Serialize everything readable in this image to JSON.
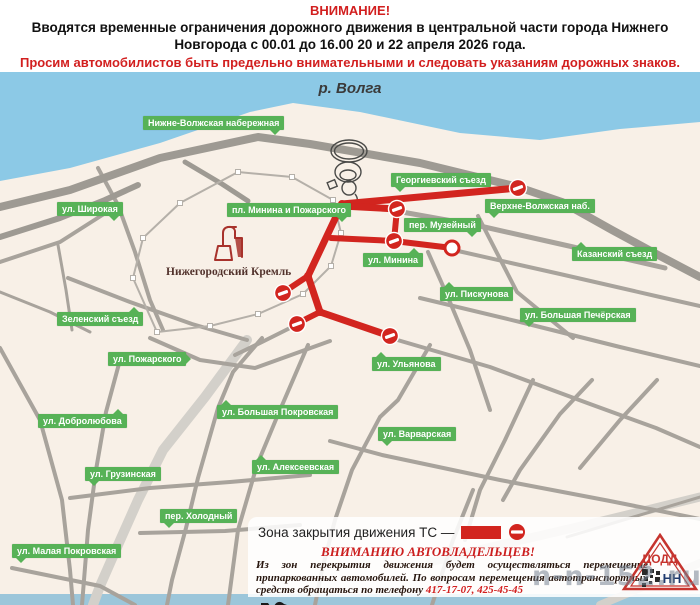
{
  "header": {
    "title": "ВНИМАНИЕ!",
    "body": "Вводятся временные ограничения дорожного движения в центральной части города Нижнего Новгорода с 00.01 до 16.00 20 и 22 апреля 2026 года.",
    "warning": "Просим автомобилистов быть предельно внимательными и следовать указаниям дорожных знаков."
  },
  "map": {
    "river_label": "р. Волга",
    "kremlin_label": "Нижегородский Кремль",
    "street_labels": [
      {
        "t": "Нижне-Волжская набережная",
        "x": 143,
        "y": 116,
        "tail": "br"
      },
      {
        "t": "ул. Широкая",
        "x": 57,
        "y": 202,
        "tail": "br"
      },
      {
        "t": "пл. Минина и Пожарского",
        "x": 227,
        "y": 203,
        "tail": "br"
      },
      {
        "t": "Георгиевский съезд",
        "x": 391,
        "y": 173,
        "tail": "bl"
      },
      {
        "t": "Верхне-Волжская наб.",
        "x": 485,
        "y": 199,
        "tail": "bl"
      },
      {
        "t": "пер. Музейный",
        "x": 404,
        "y": 218,
        "tail": "br"
      },
      {
        "t": "ул. Минина",
        "x": 363,
        "y": 253,
        "tail": "tr"
      },
      {
        "t": "Казанский съезд",
        "x": 572,
        "y": 247,
        "tail": "tl"
      },
      {
        "t": "ул. Пискунова",
        "x": 440,
        "y": 287,
        "tail": "tl"
      },
      {
        "t": "ул. Большая Печёрская",
        "x": 520,
        "y": 308,
        "tail": "bl"
      },
      {
        "t": "ул. Ульянова",
        "x": 372,
        "y": 357,
        "tail": "tl"
      },
      {
        "t": "ул. Варварская",
        "x": 378,
        "y": 427,
        "tail": "bl"
      },
      {
        "t": "Зеленский съезд",
        "x": 57,
        "y": 312,
        "tail": "tr"
      },
      {
        "t": "ул. Пожарского",
        "x": 108,
        "y": 352,
        "tail": "r"
      },
      {
        "t": "ул. Добролюбова",
        "x": 38,
        "y": 414,
        "tail": "tr"
      },
      {
        "t": "ул. Большая Покровская",
        "x": 217,
        "y": 405,
        "tail": "tl"
      },
      {
        "t": "ул. Грузинская",
        "x": 85,
        "y": 467,
        "tail": "bl"
      },
      {
        "t": "ул. Алексеевская",
        "x": 252,
        "y": 460,
        "tail": "tl"
      },
      {
        "t": "пер. Холодный",
        "x": 160,
        "y": 509,
        "tail": "bl"
      },
      {
        "t": "ул. Малая Покровская",
        "x": 12,
        "y": 544,
        "tail": "bl"
      }
    ],
    "colors": {
      "water": "#8cc9e6",
      "land": "#f8f0e7",
      "road": "#a8a39c",
      "road_dark": "#9e9a93",
      "road_light": "#d3d0ca",
      "closed": "#d2251f",
      "label_bg": "#57b257",
      "wall": "#b5b0a9",
      "bottom_strip": "#9cc6da"
    },
    "geometry": {
      "water": [
        [
          0,
          72
        ],
        [
          700,
          72
        ],
        [
          700,
          122
        ],
        [
          620,
          129
        ],
        [
          540,
          140
        ],
        [
          460,
          133
        ],
        [
          360,
          112
        ],
        [
          293,
          103
        ],
        [
          250,
          112
        ],
        [
          160,
          143
        ],
        [
          70,
          168
        ],
        [
          0,
          181
        ]
      ],
      "bottom_strip": {
        "y": 594,
        "h": 11
      },
      "thick_roads": [
        {
          "pts": [
            [
              0,
              207
            ],
            [
              70,
              190
            ],
            [
              160,
              158
            ],
            [
              258,
              137
            ],
            [
              310,
              144
            ],
            [
              420,
              163
            ],
            [
              518,
              187
            ]
          ],
          "w": 8
        },
        {
          "pts": [
            [
              518,
              187
            ],
            [
              562,
              202
            ],
            [
              612,
              230
            ],
            [
              660,
              256
            ],
            [
              700,
              277
            ]
          ],
          "w": 8
        },
        {
          "pts": [
            [
              0,
              237
            ],
            [
              60,
              218
            ],
            [
              105,
              200
            ],
            [
              138,
              185
            ]
          ],
          "w": 6
        },
        {
          "pts": [
            [
              185,
              162
            ],
            [
              222,
              184
            ],
            [
              248,
              201
            ]
          ],
          "w": 5
        }
      ],
      "roads": [
        {
          "pts": [
            [
              402,
              212
            ],
            [
              480,
              226
            ],
            [
              560,
              244
            ],
            [
              622,
              258
            ],
            [
              665,
              268
            ]
          ],
          "w": 5
        },
        {
          "pts": [
            [
              458,
              251
            ],
            [
              560,
              274
            ],
            [
              660,
              297
            ],
            [
              700,
              306
            ]
          ],
          "w": 4
        },
        {
          "pts": [
            [
              420,
              298
            ],
            [
              520,
              322
            ],
            [
              620,
              347
            ],
            [
              700,
              366
            ]
          ],
          "w": 4
        },
        {
          "pts": [
            [
              394,
              339
            ],
            [
              490,
              367
            ],
            [
              590,
              404
            ],
            [
              656,
              428
            ],
            [
              700,
              447
            ]
          ],
          "w": 4
        },
        {
          "pts": [
            [
              330,
              441
            ],
            [
              382,
              455
            ],
            [
              500,
              480
            ],
            [
              610,
              501
            ],
            [
              700,
              519
            ]
          ],
          "w": 4
        },
        {
          "pts": [
            [
              478,
              216
            ],
            [
              517,
              292
            ],
            [
              573,
              338
            ]
          ],
          "w": 4
        },
        {
          "pts": [
            [
              428,
              252
            ],
            [
              447,
              295
            ],
            [
              470,
              350
            ],
            [
              490,
              410
            ]
          ],
          "w": 4
        },
        {
          "pts": [
            [
              430,
              345
            ],
            [
              398,
              400
            ],
            [
              380,
              417
            ],
            [
              352,
              470
            ],
            [
              335,
              520
            ],
            [
              322,
              570
            ],
            [
              315,
              605
            ]
          ],
          "w": 4
        },
        {
          "pts": [
            [
              533,
              380
            ],
            [
              505,
              440
            ],
            [
              480,
              490
            ],
            [
              465,
              540
            ]
          ],
          "w": 4
        },
        {
          "pts": [
            [
              592,
              380
            ],
            [
              560,
              414
            ],
            [
              520,
              470
            ],
            [
              503,
              500
            ]
          ],
          "w": 4
        },
        {
          "pts": [
            [
              657,
              380
            ],
            [
              620,
              420
            ],
            [
              580,
              468
            ]
          ],
          "w": 4
        },
        {
          "pts": [
            [
              473,
              490
            ],
            [
              453,
              540
            ],
            [
              440,
              580
            ],
            [
              432,
              605
            ]
          ],
          "w": 4
        },
        {
          "pts": [
            [
              98,
              168
            ],
            [
              118,
              205
            ],
            [
              135,
              252
            ],
            [
              150,
              300
            ],
            [
              163,
              330
            ]
          ],
          "w": 4
        },
        {
          "pts": [
            [
              118,
              205
            ],
            [
              60,
              242
            ],
            [
              0,
              262
            ]
          ],
          "w": 4
        },
        {
          "pts": [
            [
              68,
              278
            ],
            [
              130,
              302
            ],
            [
              192,
              324
            ],
            [
              247,
              340
            ]
          ],
          "w": 4
        },
        {
          "pts": [
            [
              150,
              338
            ],
            [
              200,
              360
            ],
            [
              255,
              368
            ],
            [
              305,
              350
            ],
            [
              330,
              341
            ]
          ],
          "w": 4
        },
        {
          "pts": [
            [
              120,
              360
            ],
            [
              106,
              412
            ],
            [
              96,
              470
            ],
            [
              88,
              530
            ],
            [
              82,
              605
            ]
          ],
          "w": 4
        },
        {
          "pts": [
            [
              262,
              338
            ],
            [
              233,
              372
            ],
            [
              218,
              408
            ],
            [
              198,
              478
            ],
            [
              186,
              528
            ],
            [
              172,
              580
            ],
            [
              167,
              605
            ]
          ],
          "w": 4
        },
        {
          "pts": [
            [
              308,
              345
            ],
            [
              277,
              417
            ],
            [
              257,
              465
            ],
            [
              238,
              530
            ],
            [
              228,
              605
            ]
          ],
          "w": 4
        },
        {
          "pts": [
            [
              70,
              498
            ],
            [
              150,
              488
            ],
            [
              230,
              482
            ],
            [
              310,
              475
            ]
          ],
          "w": 4
        },
        {
          "pts": [
            [
              140,
              533
            ],
            [
              225,
              531
            ],
            [
              300,
              525
            ]
          ],
          "w": 4
        },
        {
          "pts": [
            [
              12,
              568
            ],
            [
              100,
              586
            ],
            [
              135,
              605
            ]
          ],
          "w": 4
        },
        {
          "pts": [
            [
              0,
              348
            ],
            [
              40,
              420
            ],
            [
              62,
              500
            ],
            [
              70,
              570
            ],
            [
              73,
              605
            ]
          ],
          "w": 4
        },
        {
          "pts": [
            [
              0,
              292
            ],
            [
              50,
              312
            ],
            [
              90,
              332
            ]
          ],
          "w": 3
        },
        {
          "pts": [
            [
              58,
              245
            ],
            [
              66,
              290
            ],
            [
              72,
              330
            ]
          ],
          "w": 3
        },
        {
          "pts": [
            [
              296,
              325
            ],
            [
              262,
              342
            ],
            [
              235,
              355
            ]
          ],
          "w": 4
        },
        {
          "pts": [
            [
              567,
              537
            ],
            [
              700,
              497
            ]
          ],
          "w": 3
        }
      ],
      "light_roads": [
        {
          "pts": [
            [
              247,
              340
            ],
            [
              205,
              397
            ],
            [
              163,
              450
            ],
            [
              138,
              500
            ],
            [
              118,
              545
            ],
            [
              100,
              586
            ],
            [
              93,
              605
            ]
          ],
          "w": 10
        },
        {
          "pts": [
            [
              700,
              497
            ],
            [
              590,
              524
            ],
            [
              470,
              552
            ],
            [
              430,
              562
            ]
          ],
          "w": 9
        },
        {
          "pts": [
            [
              600,
              605
            ],
            [
              700,
              563
            ]
          ],
          "w": 8
        }
      ],
      "kremlin_wall": [
        [
          238,
          172
        ],
        [
          292,
          177
        ],
        [
          333,
          200
        ],
        [
          341,
          233
        ],
        [
          331,
          266
        ],
        [
          303,
          294
        ],
        [
          258,
          314
        ],
        [
          210,
          326
        ],
        [
          157,
          332
        ],
        [
          133,
          278
        ],
        [
          143,
          238
        ],
        [
          180,
          203
        ]
      ],
      "closed": [
        {
          "pts": [
            [
              342,
              204
            ],
            [
              518,
              188
            ]
          ],
          "w": 7
        },
        {
          "pts": [
            [
              342,
              206
            ],
            [
              397,
              209
            ]
          ],
          "w": 7
        },
        {
          "pts": [
            [
              397,
              209
            ],
            [
              394,
              241
            ]
          ],
          "w": 6
        },
        {
          "pts": [
            [
              394,
              241
            ],
            [
              452,
              248
            ]
          ],
          "w": 6
        },
        {
          "pts": [
            [
              342,
              204
            ],
            [
              308,
              276
            ]
          ],
          "w": 7
        },
        {
          "pts": [
            [
              331,
              238
            ],
            [
              394,
              241
            ]
          ],
          "w": 6
        },
        {
          "pts": [
            [
              308,
              276
            ],
            [
              284,
              292
            ]
          ],
          "w": 6
        },
        {
          "pts": [
            [
              308,
              276
            ],
            [
              320,
              312
            ]
          ],
          "w": 7
        },
        {
          "pts": [
            [
              320,
              312
            ],
            [
              298,
              323
            ]
          ],
          "w": 6
        },
        {
          "pts": [
            [
              320,
              312
            ],
            [
              390,
              336
            ]
          ],
          "w": 7
        }
      ],
      "signs": [
        [
          518,
          188
        ],
        [
          397,
          209
        ],
        [
          394,
          241
        ],
        [
          283,
          293
        ],
        [
          297,
          324
        ],
        [
          390,
          336
        ]
      ],
      "open_circle": [
        452,
        248
      ],
      "junctions": [
        [
          342,
          204
        ],
        [
          308,
          276
        ],
        [
          320,
          312
        ]
      ]
    }
  },
  "legend": {
    "label": "Зона закрытия движения ТС —"
  },
  "notice": {
    "title": "ВНИМАНИЮ АВТОВЛАДЕЛЬЦЕВ!",
    "body": "Из зон перекрытия движения будет осуществляться перемещение припаркованных автомобилей.  По вопросам перемещения автотранспортных средств обращаться по телефону ",
    "phones": "417-17-07, 425-45-45"
  },
  "logo": {
    "org": "ЦОДД",
    "region": "НН"
  },
  "watermark": {
    "text": "n-n-152.ru"
  }
}
